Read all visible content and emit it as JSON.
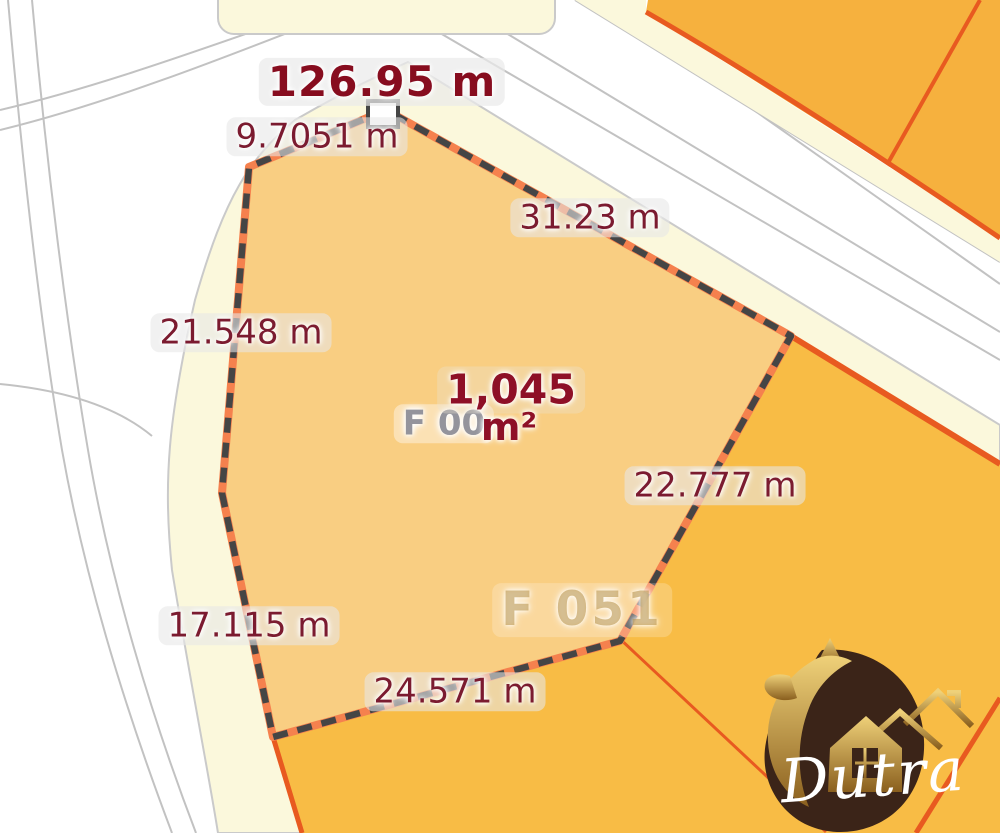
{
  "map": {
    "selected_parcel": {
      "perimeter_label": "126.95 m",
      "area_value": "1,045",
      "area_unit": "m²",
      "underlying_code": "F 00",
      "edge_labels": {
        "northwest": "9.7051 m",
        "northeast": "31.23 m",
        "west": "21.548 m",
        "east": "22.777 m",
        "southwest": "17.115 m",
        "south": "24.571 m"
      }
    },
    "neighbor_parcel_code": "F 051",
    "colors": {
      "selected_parcel_fill": "#F9CE82",
      "neighbor_parcel_fill_ne": "#F6B13E",
      "neighbor_parcel_fill_se": "#F8BC45",
      "parcel_border": "#E85A20",
      "boundary_dash": "#454545",
      "boundary_underlay": "#F5814E",
      "road_verge": "#FBF8DC",
      "road_surface": "#FFFFFF",
      "road_line": "#C2C2C2",
      "measurement_text": "#7B1B30",
      "title_text": "#870D1F"
    }
  },
  "logo": {
    "brand": "Dutra"
  }
}
